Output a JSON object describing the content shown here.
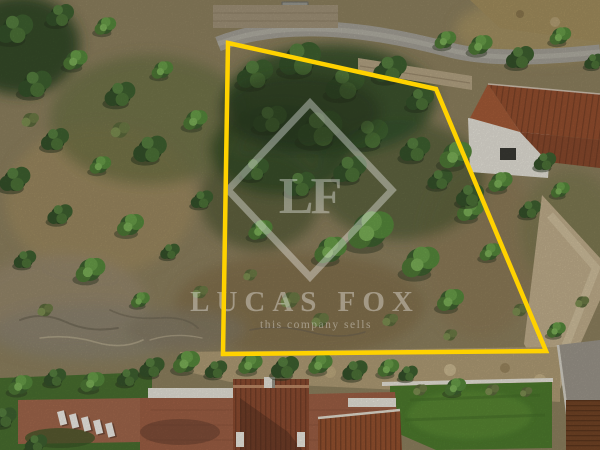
{
  "photo": {
    "kind": "aerial-drone-photo",
    "subject": "building plot outlined in yellow among pine woodland, villas with terracotta roofs below and beside"
  },
  "watermark": {
    "monogram": "LF",
    "brand": "LUCAS FOX",
    "tagline": "this company sells",
    "color": "#ffffff"
  },
  "boundary": {
    "points": "228,43 436,89 546,351 223,354",
    "color": "#ffd200"
  },
  "colors": {
    "boundary_yellow": "#ffd200",
    "watermark_white": "#ffffff",
    "pine_green": "#3c5a2e",
    "scrub_tan": "#9a8a63",
    "roof_terracotta": "#96502f",
    "lawn_green": "#4e7c2e",
    "road_grey": "#a6a298"
  }
}
